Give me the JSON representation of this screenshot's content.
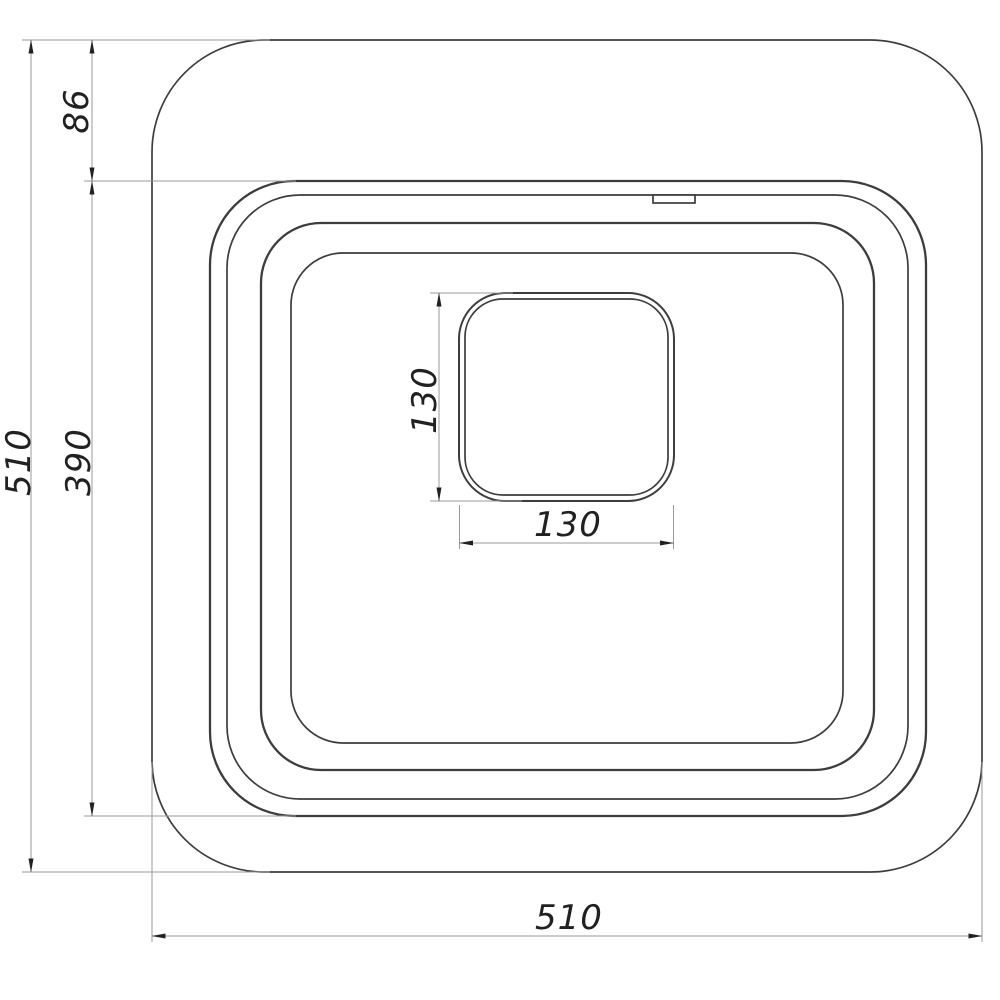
{
  "drawing": {
    "subject": "square-sink-top-view-technical-drawing"
  },
  "dimensions": {
    "overall_height": "510",
    "bowl_depth": "390",
    "rim_offset_top": "86",
    "drain_height": "130",
    "drain_width": "130",
    "overall_width": "510"
  },
  "colors": {
    "background": "#ffffff",
    "outline": "#3d3d3d",
    "dimension_line": "#9a9a9a",
    "text": "#212121"
  }
}
